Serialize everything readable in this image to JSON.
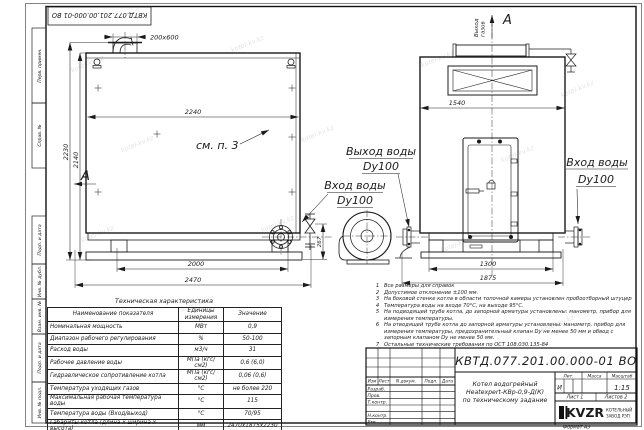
{
  "watermark": "kotel-kv.kz",
  "stamp": {
    "text": "КВТД.077.201.00.000-01 ВО"
  },
  "margin_labels": [
    "Перв. примен.",
    "Справ. №",
    "Подп. и дата",
    "Инв. № дубл.",
    "Взам. инв. №",
    "Подп. и дата",
    "Инв. № подл."
  ],
  "drawing": {
    "front": {
      "dim_stub": "200x600",
      "dim_width": "2240",
      "dim_height_total": "2230",
      "dim_height_body": "2140",
      "dim_base": "2000",
      "dim_length_total": "2470",
      "dim_pipe": "267",
      "see_note": "см. п. 3"
    },
    "side": {
      "dim_width": "1540",
      "dim_base": "1300",
      "dim_length_total": "1875"
    },
    "gas_label_1": "Выход",
    "gas_label_2": "газов",
    "view_letter": "A",
    "water_out": {
      "line1": "Выход воды",
      "line2": "Dy100"
    },
    "water_in_front": {
      "line1": "Вход воды",
      "line2": "Dy100"
    },
    "water_in_side": {
      "line1": "Вход воды",
      "line2": "Dy100"
    }
  },
  "tech_table": {
    "title": "Техническая характеристика",
    "headers": [
      "Наименование показателя",
      "Единицы измерения",
      "Значение"
    ],
    "rows": [
      {
        "name": "Номинальная мощность",
        "unit": "МВт",
        "value": "0,9"
      },
      {
        "name": "Диапазон рабочего регулирования",
        "unit": "%",
        "value": "50-100"
      },
      {
        "name": "Расход воды",
        "unit": "м3/ч",
        "value": "31"
      },
      {
        "name": "Рабочее давление воды",
        "unit": "МПа (кгс/см2)",
        "value": "0,6 (6,0)"
      },
      {
        "name": "Гидравлическое сопротивление котла",
        "unit": "МПа (кгс/см2)",
        "value": "0,06 (0,6)"
      },
      {
        "name": "Температура уходящих газов",
        "unit": "°С",
        "value": "не более 220"
      },
      {
        "name": "Максимальная рабочая температура воды",
        "unit": "°С",
        "value": "115"
      },
      {
        "name": "Температура воды (Вход/выход)",
        "unit": "°С",
        "value": "70/95"
      },
      {
        "name": "Габариты котла (длина х ширина х высота)",
        "unit": "мм",
        "value": "2470х1875х2230"
      }
    ]
  },
  "notes": [
    {
      "n": "1",
      "text": "Все размеры для справок"
    },
    {
      "n": "2",
      "text": "Допустимое отклонение ±100 мм."
    },
    {
      "n": "3",
      "text": "На боковой стенке котла в области топочной камеры установлен пробоотборный штуцер"
    },
    {
      "n": "4",
      "text": "Температура воды на входе 70°С, на выходе 95°С."
    },
    {
      "n": "5",
      "text": "На подводящей трубе котла, до запорной арматуры установлены: манометр, прибор для измерения температуры."
    },
    {
      "n": "6",
      "text": "На отводящей трубе котла до запорной арматуры установлены: манометр, прибор для измерения температуры, предохранительный клапан Dy не менее 50 мм и обвод с запорным клапаном Dy не менее 50 мм."
    },
    {
      "n": "7",
      "text": "Остальные технические требования по ОСТ 108.030.135-84"
    }
  ],
  "title_block": {
    "doc_number": "КВТД.077.201.00.000-01 ВО",
    "name_line1": "Котел водогрейный",
    "name_line2": "Heatexpert-КВр-0,9-Д(К)",
    "name_line3": "по техническому задание",
    "lit_header": "Лит.",
    "mass_header": "Масса",
    "scale_header": "Масштаб",
    "lit_value": "И",
    "scale_value": "1:15",
    "sheet_label": "Лист 1",
    "sheets_label": "Листов 2",
    "rev_cols": [
      "Изм",
      "Лист",
      "N докум.",
      "Подп.",
      "Дата"
    ],
    "sig_rows": [
      "Разраб.",
      "Пров.",
      "Т.контр.",
      "Н.контр.",
      "Утв."
    ],
    "logo_text": "KVZR",
    "logo_sub1": "КОТЕЛЬНЫЙ",
    "logo_sub2": "ЗАВОД РЭП"
  },
  "format_label": "Формат А3"
}
